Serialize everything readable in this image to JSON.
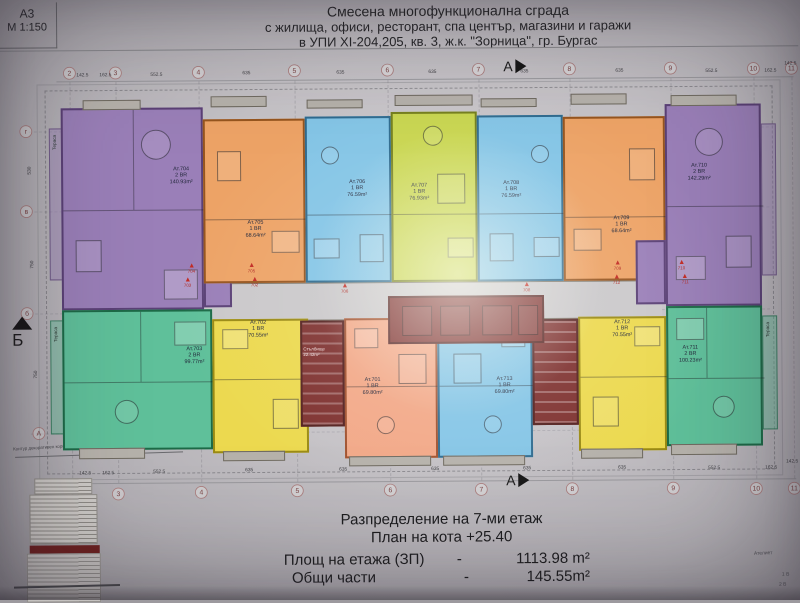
{
  "title_block": {
    "sheet": "A3",
    "scale": "М 1:150"
  },
  "title": {
    "line1": "Смесена многофункционална сграда",
    "line2": "с жилища, офиси, ресторант, спа център, магазини и  гаражи",
    "line3": "в УПИ XI-204,205, кв. 3, ж.к. \"Зорница\", гр. Бургас"
  },
  "grid": {
    "top_labels": [
      "2",
      "3",
      "4",
      "5",
      "6",
      "7",
      "8",
      "9",
      "10",
      "11"
    ],
    "left_labels": [
      "г",
      "в",
      "б",
      "А"
    ],
    "dims": [
      "142.5",
      "162.5",
      "552.5",
      "635",
      "635",
      "635",
      "635",
      "635",
      "552.5",
      "162.5",
      "142.5"
    ],
    "left_dims": [
      "530",
      "750",
      "750"
    ],
    "section_a": "А",
    "section_b": "Б"
  },
  "plan": {
    "corridor_color": "#cac8ca",
    "core_color": "#7e312f",
    "core_wall": "#53201e"
  },
  "apartments": [
    {
      "name": "Ат.704",
      "rooms": "2 BR",
      "area": "140.93m²",
      "color": "#9a7fb8",
      "wall": "#5b4176"
    },
    {
      "name": "Ат.705",
      "rooms": "1 BR",
      "area": "68.64m²",
      "color": "#eda366",
      "wall": "#96551f"
    },
    {
      "name": "Ат.706",
      "rooms": "1 BR",
      "area": "76.59m²",
      "color": "#84c5e6",
      "wall": "#2f6b8f"
    },
    {
      "name": "Ат.707",
      "rooms": "1 BR",
      "area": "76.93m²",
      "color": "#c9d64f",
      "wall": "#75801d"
    },
    {
      "name": "Ат.708",
      "rooms": "1 BR",
      "area": "76.59m²",
      "color": "#84c5e6",
      "wall": "#2f6b8f"
    },
    {
      "name": "Ат.709",
      "rooms": "1 BR",
      "area": "68.64m²",
      "color": "#eda366",
      "wall": "#96551f"
    },
    {
      "name": "Ат.710",
      "rooms": "2 BR",
      "area": "142.29m²",
      "color": "#9a7fb8",
      "wall": "#5b4176"
    },
    {
      "name": "Ат.703",
      "rooms": "2 BR",
      "area": "99.77m²",
      "color": "#5fc09a",
      "wall": "#1d6a47"
    },
    {
      "name": "Ат.702",
      "rooms": "1 BR",
      "area": "70.55m²",
      "color": "#ecd94f",
      "wall": "#9a8a14"
    },
    {
      "name": "Ат.701",
      "rooms": "1 BR",
      "area": "69.80m²",
      "color": "#f2a887",
      "wall": "#a0512e"
    },
    {
      "name": "Ат.713",
      "rooms": "1 BR",
      "area": "69.80m²",
      "color": "#84c5e6",
      "wall": "#2f6b8f"
    },
    {
      "name": "Ат.712",
      "rooms": "1 BR",
      "area": "70.55m²",
      "color": "#ecd94f",
      "wall": "#9a8a14"
    },
    {
      "name": "Ат.711",
      "rooms": "2 BR",
      "area": "100.23m²",
      "color": "#5fc09a",
      "wall": "#1d6a47"
    }
  ],
  "stairwell": {
    "label": "Стълбище",
    "area": "22.42m²"
  },
  "terrace_label": "Тераса",
  "cornice_note": "Контур декоративен корниз",
  "vent_markers": [
    "704",
    "705",
    "706",
    "708",
    "709",
    "710",
    "703",
    "702",
    "712",
    "711"
  ],
  "footer": {
    "line1": "Разпределение на 7-ми  етаж",
    "line2": "План на кота  +25.40",
    "row1_label": "Площ на етажа (ЗП)",
    "row1_dash": "-",
    "row1_value": "1113.98 m²",
    "row2_label": "Общи части",
    "row2_dash": "-",
    "row2_value": "145.55m²"
  },
  "legend_cut": {
    "l1": "Ателиет",
    "l2": "1 В",
    "l3": "2 В"
  }
}
